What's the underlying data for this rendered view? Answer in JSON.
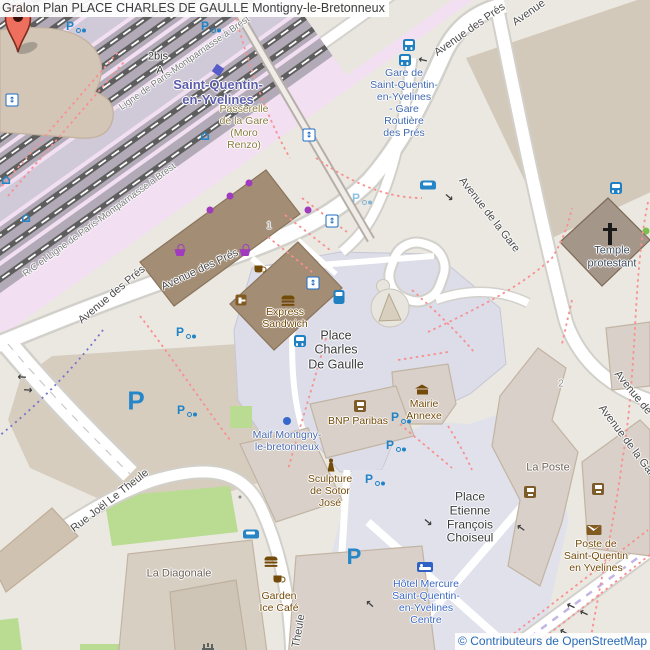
{
  "header": {
    "title": "Gralon Plan PLACE CHARLES DE GAULLE Montigny-le-Bretonneux"
  },
  "attribution": {
    "text": "© Contributeurs de OpenStreetMap"
  },
  "colors": {
    "marker_red": "#ee6f5e",
    "transit_blue": "#2180c2",
    "parking_blue": "#2586c9",
    "amenity_brown": "#734a08",
    "rail_pink": "#f2dff2",
    "pedestrian_lavender": "#dcdde8",
    "attribution_blue": "#2a6bb8"
  },
  "marker": {
    "name": "place-charles-de-gaulle-pin",
    "x": 333,
    "y": 330
  },
  "labels": [
    {
      "id": "railway-line-name-1",
      "text": "Ligne de Paris-Montparnasse à Brest",
      "x": 185,
      "y": 64,
      "rot": -35,
      "color": "#7a7a7a",
      "size": 9.5
    },
    {
      "id": "railway-line-name-2",
      "text": "R.C et Ligne de Paris-Montparnasse à Brest",
      "x": 100,
      "y": 221,
      "rot": -36,
      "color": "#7a7a7a",
      "size": 9.5
    },
    {
      "id": "platform-2bis",
      "text": "2bis",
      "x": 158,
      "y": 57,
      "color": "#333333",
      "size": 11
    },
    {
      "id": "platform-a",
      "text": "A",
      "x": 160,
      "y": 71,
      "color": "#333333",
      "size": 11
    },
    {
      "id": "station-name",
      "text": "Saint-Quentin-\nen-Yvelines",
      "x": 218,
      "y": 93,
      "color": "#5c5caa",
      "size": 13,
      "bold": true
    },
    {
      "id": "passerelle",
      "text": "Passerelle\nde la Gare\n(Moro\nRenzo)",
      "x": 244,
      "y": 127,
      "color": "#8a7a3e",
      "size": 10.5
    },
    {
      "id": "gare-routiere",
      "text": "Gare de\nSaint-Quentin-\nen-Yvelines\n- Gare\nRoutière\ndes Prés",
      "x": 404,
      "y": 103,
      "color": "#4169b1",
      "size": 10.5
    },
    {
      "id": "avenue-des-pres-1",
      "text": "Avenue des Prés",
      "x": 112,
      "y": 295,
      "rot": -40,
      "color": "#4a4a4a",
      "size": 11
    },
    {
      "id": "avenue-des-pres-2",
      "text": "Avenue des Prés",
      "x": 200,
      "y": 270,
      "rot": -25,
      "color": "#4a4a4a",
      "size": 11
    },
    {
      "id": "avenue-des-pres-3",
      "text": "Avenue des Prés",
      "x": 470,
      "y": 30,
      "rot": -35,
      "color": "#4a4a4a",
      "size": 11
    },
    {
      "id": "avenue-top",
      "text": "Avenue",
      "x": 529,
      "y": 13,
      "rot": -35,
      "color": "#4a4a4a",
      "size": 11
    },
    {
      "id": "avenue-de-la-gare-1",
      "text": "Avenue de la Gare",
      "x": 489,
      "y": 215,
      "rot": 52,
      "color": "#4a4a4a",
      "size": 11
    },
    {
      "id": "avenue-de-la-gare-2",
      "text": "Avenue de la Gare",
      "x": 645,
      "y": 408,
      "rot": 51,
      "color": "#4a4a4a",
      "size": 11
    },
    {
      "id": "avenue-de-la-gare-3",
      "text": "Avenue de la Gare",
      "x": 628,
      "y": 443,
      "rot": 53,
      "color": "#4a4a4a",
      "size": 11
    },
    {
      "id": "temple-protestant",
      "text": "Temple\nprotestant",
      "x": 612,
      "y": 257,
      "color": "#3f4d5a",
      "size": 11
    },
    {
      "id": "place-charles-de-gaulle",
      "text": "Place\nCharles\nDe Gaulle",
      "x": 336,
      "y": 350,
      "color": "#3a3a3a",
      "size": 12.5
    },
    {
      "id": "express-sandwich",
      "text": "Express\nSandwich",
      "x": 285,
      "y": 318,
      "color": "#734a08",
      "size": 10.5
    },
    {
      "id": "bnp-paribas",
      "text": "BNP Paribas",
      "x": 358,
      "y": 421,
      "color": "#734a08",
      "size": 10.5
    },
    {
      "id": "mairie-annexe",
      "text": "Mairie\nAnnexe",
      "x": 424,
      "y": 410,
      "color": "#734a08",
      "size": 10.5
    },
    {
      "id": "maif",
      "text": "Maif Montigny-\nle-bretonneux",
      "x": 287,
      "y": 441,
      "color": "#4a69ad",
      "size": 10.5
    },
    {
      "id": "sculpture",
      "text": "Sculpture\nde Sotor\nJosé",
      "x": 330,
      "y": 491,
      "color": "#734a08",
      "size": 10.5
    },
    {
      "id": "la-poste",
      "text": "La Poste",
      "x": 548,
      "y": 468,
      "color": "#6e6257",
      "size": 11
    },
    {
      "id": "place-etienne",
      "text": "Place\nEtienne\nFrançois\nChoiseul",
      "x": 470,
      "y": 518,
      "color": "#3a3a3a",
      "size": 12
    },
    {
      "id": "hotel-mercure",
      "text": "Hôtel Mercure\nSaint-Quentin-\nen-Yvelines\nCentre",
      "x": 426,
      "y": 602,
      "color": "#3c69c4",
      "size": 10.5
    },
    {
      "id": "poste-sqy",
      "text": "Poste de\nSaint-Quentin\nen Yvelines",
      "x": 596,
      "y": 556,
      "color": "#734a08",
      "size": 10.5
    },
    {
      "id": "la-diagonale",
      "text": "La Diagonale",
      "x": 179,
      "y": 574,
      "color": "#6e6257",
      "size": 11
    },
    {
      "id": "garden-ice-cafe",
      "text": "Garden\nIce Café",
      "x": 279,
      "y": 602,
      "color": "#734a08",
      "size": 10.5
    },
    {
      "id": "rue-joel-le-theule",
      "text": "Rue Joël Le Theule",
      "x": 110,
      "y": 501,
      "rot": -38,
      "color": "#4a4a4a",
      "size": 11
    },
    {
      "id": "theule",
      "text": "Theule",
      "x": 299,
      "y": 631,
      "rot": -80,
      "color": "#4a4a4a",
      "size": 11
    },
    {
      "id": "housenumber-1",
      "text": "1",
      "x": 269,
      "y": 226,
      "color": "#8d8d8d",
      "size": 10
    },
    {
      "id": "housenumber-2",
      "text": "2",
      "x": 561,
      "y": 384,
      "color": "#8d8d8d",
      "size": 10
    }
  ],
  "icons": [
    {
      "type": "bus",
      "x": 409,
      "y": 45
    },
    {
      "type": "bus",
      "x": 405,
      "y": 60
    },
    {
      "type": "bus",
      "x": 616,
      "y": 188
    },
    {
      "type": "bus",
      "x": 300,
      "y": 341
    },
    {
      "type": "tram",
      "x": 339,
      "y": 297
    },
    {
      "type": "elevator",
      "x": 12,
      "y": 100
    },
    {
      "type": "elevator",
      "x": 309,
      "y": 135
    },
    {
      "type": "elevator",
      "x": 332,
      "y": 221
    },
    {
      "type": "elevator",
      "x": 313,
      "y": 283
    },
    {
      "type": "shelter",
      "x": 6,
      "y": 180
    },
    {
      "type": "shelter",
      "x": 26,
      "y": 218
    },
    {
      "type": "shelter",
      "x": 205,
      "y": 136
    },
    {
      "type": "bikep",
      "x": 70,
      "y": 26
    },
    {
      "type": "bikep",
      "x": 205,
      "y": 26
    },
    {
      "type": "bikep",
      "x": 180,
      "y": 332
    },
    {
      "type": "bikep",
      "x": 181,
      "y": 410
    },
    {
      "type": "bikep",
      "x": 395,
      "y": 417
    },
    {
      "type": "bikep",
      "x": 390,
      "y": 445
    },
    {
      "type": "bikep",
      "x": 369,
      "y": 479
    },
    {
      "type": "bikep",
      "x": 356,
      "y": 198,
      "op": 0.5
    },
    {
      "type": "bigp",
      "x": 136,
      "y": 401,
      "size": 26
    },
    {
      "type": "bigp",
      "x": 354,
      "y": 557,
      "size": 22
    },
    {
      "type": "taxi",
      "x": 428,
      "y": 185
    },
    {
      "type": "carrental",
      "x": 251,
      "y": 534
    },
    {
      "type": "basket",
      "x": 180,
      "y": 250
    },
    {
      "type": "basket",
      "x": 245,
      "y": 250
    },
    {
      "type": "coffee",
      "x": 261,
      "y": 270
    },
    {
      "type": "coffee",
      "x": 280,
      "y": 580
    },
    {
      "type": "burger",
      "x": 288,
      "y": 301
    },
    {
      "type": "burger",
      "x": 271,
      "y": 562
    },
    {
      "type": "door",
      "x": 241,
      "y": 300
    },
    {
      "type": "atm",
      "x": 360,
      "y": 406
    },
    {
      "type": "atm",
      "x": 530,
      "y": 492
    },
    {
      "type": "atm",
      "x": 598,
      "y": 489
    },
    {
      "type": "mail",
      "x": 594,
      "y": 530
    },
    {
      "type": "hall",
      "x": 422,
      "y": 388
    },
    {
      "type": "statue",
      "x": 331,
      "y": 465
    },
    {
      "type": "cross",
      "x": 610,
      "y": 234
    },
    {
      "type": "fountain",
      "x": 208,
      "y": 646
    },
    {
      "type": "hotel",
      "x": 425,
      "y": 567
    },
    {
      "type": "shopdot",
      "x": 249,
      "y": 183
    },
    {
      "type": "shopdot",
      "x": 230,
      "y": 196
    },
    {
      "type": "shopdot",
      "x": 210,
      "y": 210
    },
    {
      "type": "shopdot",
      "x": 308,
      "y": 210
    },
    {
      "type": "indigo",
      "x": 218,
      "y": 70,
      "rot": 35
    },
    {
      "type": "bluedot",
      "x": 287,
      "y": 421
    },
    {
      "type": "graydot",
      "x": 240,
      "y": 497
    },
    {
      "type": "arrow",
      "x": 423,
      "y": 60,
      "rot": 193
    },
    {
      "type": "arrow",
      "x": 449,
      "y": 197,
      "rot": 40
    },
    {
      "type": "arrow",
      "x": 428,
      "y": 522,
      "rot": 40
    },
    {
      "type": "arrow",
      "x": 521,
      "y": 528,
      "rot": 215
    },
    {
      "type": "arrow",
      "x": 370,
      "y": 604,
      "rot": 222
    },
    {
      "type": "arrow",
      "x": 571,
      "y": 606,
      "rot": 205
    },
    {
      "type": "arrow",
      "x": 584,
      "y": 613,
      "rot": 205
    },
    {
      "type": "arrow",
      "x": 564,
      "y": 632,
      "rot": 210
    },
    {
      "type": "arrow",
      "x": 22,
      "y": 377,
      "rot": 184
    },
    {
      "type": "arrow",
      "x": 28,
      "y": 390,
      "rot": 4
    }
  ]
}
